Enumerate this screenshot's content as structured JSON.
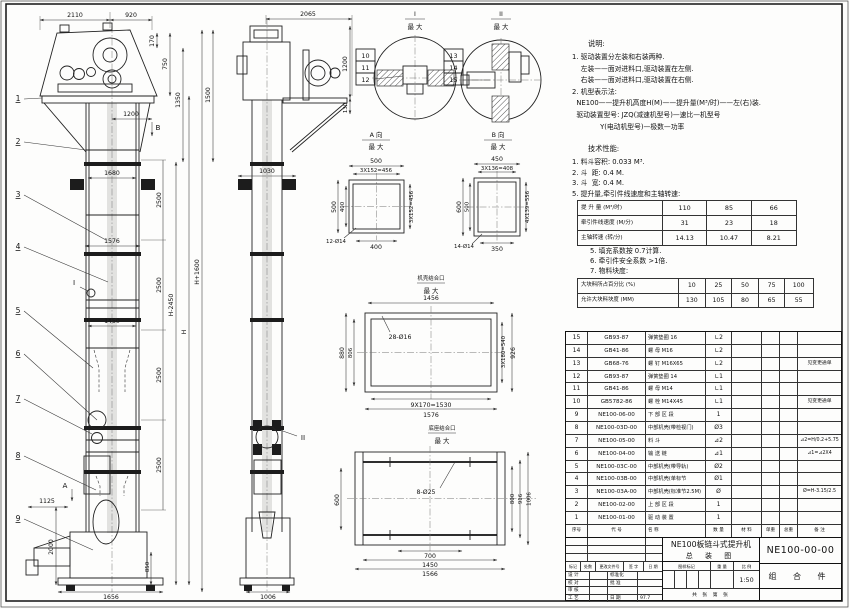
{
  "notes": {
    "title": "说明:",
    "lines": [
      "1. 驱动装置分左装和右装两种.",
      "    左装——面对进料口,驱动装置在左侧.",
      "    右装——面对进料口,驱动装置在右侧.",
      "2. 机型表示法:",
      "  NE100——提升机高度H(M)——提升量(M³/时)——左(右)装.",
      "  驱动装置型号: JZQ(减速机型号)—速比—机型号",
      "             Y(电动机型号)—极数—功率"
    ]
  },
  "specs": {
    "title": "技术性能:",
    "lines": [
      "1. 料斗容积: 0.033 M³.",
      "2. 斗  距: 0.4 M.",
      "3. 斗  宽: 0.4 M.",
      "5. 提升量,牵引件线速度和主轴转速:"
    ],
    "table1": {
      "rows": [
        {
          "label": "提 升 量  (M³/时)",
          "values": [
            "110",
            "85",
            "66"
          ]
        },
        {
          "label": "牵引件线速度 (M/分)",
          "values": [
            "31",
            "23",
            "18"
          ]
        },
        {
          "label": "主轴转速  (转/分)",
          "values": [
            "14.13",
            "10.47",
            "8.21"
          ]
        }
      ]
    },
    "lines2": [
      "5. 填充系数按 0.7计算.",
      "6. 牵引件安全系数 >1倍.",
      "7. 物料块度:"
    ],
    "table2": {
      "rows": [
        {
          "label": "大块料所占百分比 (%)",
          "values": [
            "10",
            "25",
            "50",
            "75",
            "100"
          ]
        },
        {
          "label": "允许大块料块度 (MM)",
          "values": [
            "130",
            "105",
            "80",
            "65",
            "55"
          ]
        }
      ]
    }
  },
  "bom": {
    "header": [
      "序号",
      "代  号",
      "名    称",
      "数 量",
      "材  料",
      "单重",
      "总重",
      "备  注"
    ],
    "rows": [
      {
        "no": "15",
        "code": "GB93-87",
        "name": "弹簧垫圈 16",
        "qty": "∟2",
        "remark": ""
      },
      {
        "no": "14",
        "code": "GB41-86",
        "name": "螺 母  M16",
        "qty": "∟2",
        "remark": ""
      },
      {
        "no": "13",
        "code": "GB68-76",
        "name": "螺 钉  M16X65",
        "qty": "∟2",
        "remark": "见变更通单"
      },
      {
        "no": "12",
        "code": "GB93-87",
        "name": "弹簧垫圈 14",
        "qty": "∟1",
        "remark": ""
      },
      {
        "no": "11",
        "code": "GB41-86",
        "name": "螺 母  M14",
        "qty": "∟1",
        "remark": ""
      },
      {
        "no": "10",
        "code": "GB5782-86",
        "name": "螺 栓  M14X45",
        "qty": "∟1",
        "remark": "见变更通单"
      },
      {
        "no": "9",
        "code": "NE100-06-00",
        "name": "下 部 区 段",
        "qty": "1",
        "remark": ""
      },
      {
        "no": "8",
        "code": "NE100-03D-00",
        "name": "中部机壳(带检视门)",
        "qty": "Ø3",
        "remark": ""
      },
      {
        "no": "7",
        "code": "NE100-05-00",
        "name": "料 斗",
        "qty": "⊿2",
        "remark": "⊿2=H/0.2+5.75"
      },
      {
        "no": "6",
        "code": "NE100-04-00",
        "name": "输 送 链",
        "qty": "⊿1",
        "remark": "⊿1=⊿2X4"
      },
      {
        "no": "5",
        "code": "NE100-03C-00",
        "name": "中部机壳(带导轨)",
        "qty": "Ø2",
        "remark": ""
      },
      {
        "no": "4",
        "code": "NE100-03B-00",
        "name": "中部机壳(单标节1.5M,1M)",
        "qty": "Ø1",
        "remark": ""
      },
      {
        "no": "3",
        "code": "NE100-03A-00",
        "name": "中部机壳(标准节2.5M)",
        "qty": "Ø",
        "remark": "Ø=H-3.15/2.5"
      },
      {
        "no": "2",
        "code": "NE100-02-00",
        "name": "上 部 区 段",
        "qty": "1",
        "remark": ""
      },
      {
        "no": "1",
        "code": "NE100-01-00",
        "name": "驱 动 装 置",
        "qty": "1",
        "remark": ""
      }
    ]
  },
  "titleblock": {
    "product": "NE100板链斗式提升机",
    "drawing_type": "总 装 图",
    "drawing_no": "NE100-00-00",
    "part_class": "组 合 件",
    "rev_header": [
      "标记",
      "处数",
      "更改文件号",
      "签 字",
      "日 期"
    ],
    "sig_rows": [
      {
        "l": "设 计",
        "r": "标准化",
        "v": ""
      },
      {
        "l": "校 对",
        "r": "批 准",
        "v": ""
      },
      {
        "l": "审 核",
        "r": "",
        "v": ""
      },
      {
        "l": "工 艺",
        "r": "日 期",
        "v": "97.7"
      }
    ],
    "stamp_header": {
      "mark": "图样标记",
      "weight": "重 量",
      "scale": "比 例"
    },
    "scale_value": "1:50",
    "sheet_note": "共 张 第 张"
  },
  "front": {
    "balloons": [
      "1",
      "2",
      "3",
      "4",
      "5",
      "6",
      "7",
      "8",
      "9"
    ],
    "markers": {
      "a": "A",
      "b": "B",
      "i": "I"
    },
    "dims": {
      "t2110": "2110",
      "t920": "920",
      "t170": "170",
      "t750": "750",
      "t1350": "1350",
      "t1500": "1500",
      "t1200": "1200",
      "t1680": "1680",
      "t1576": "1576",
      "t1450": "1450",
      "t2500": "2500",
      "tH2450": "H-2450",
      "tH": "H",
      "tH1600": "H+1600",
      "t1125": "1125",
      "t2000": "2000",
      "t850": "850",
      "t1656": "1656"
    }
  },
  "side": {
    "markers": {
      "ii": "II"
    },
    "dims": {
      "t2065": "2065",
      "t1200": "1200",
      "t130": "130",
      "t1030": "1030",
      "t1006": "1006"
    }
  },
  "details": {
    "i": {
      "no": "I",
      "scale": "最 大",
      "b": [
        "10",
        "11",
        "12"
      ]
    },
    "ii": {
      "no": "II",
      "scale": "最 大",
      "b": [
        "13",
        "14",
        "15"
      ]
    },
    "a": {
      "title": "A 向",
      "scale": "最 大",
      "t500": "500",
      "t456": "3X152=456",
      "l500": "500",
      "l400": "400",
      "r456": "3X152=456",
      "b400": "400",
      "holes": "12-Ø14"
    },
    "b": {
      "title": "B 向",
      "scale": "最 大",
      "t450": "450",
      "t408": "3X136=408",
      "l600": "600",
      "l500": "500",
      "r556": "4X139=556",
      "b350": "350",
      "holes": "14-Ø14"
    },
    "casing": {
      "title": "机壳结合口",
      "scale": "最 大",
      "t1456": "1456",
      "holes": "28-Ø16",
      "l880": "880",
      "l806": "806",
      "r540": "3X180=540",
      "r926": "926",
      "b1530": "9X170=1530",
      "b1576": "1576"
    },
    "base": {
      "title": "底座结合口",
      "scale": "最 大",
      "holes": "8-Ø25",
      "l600": "600",
      "r800": "800",
      "r916": "916",
      "r1006": "1006",
      "b700": "700",
      "b1450": "1450",
      "b1566": "1566"
    }
  }
}
